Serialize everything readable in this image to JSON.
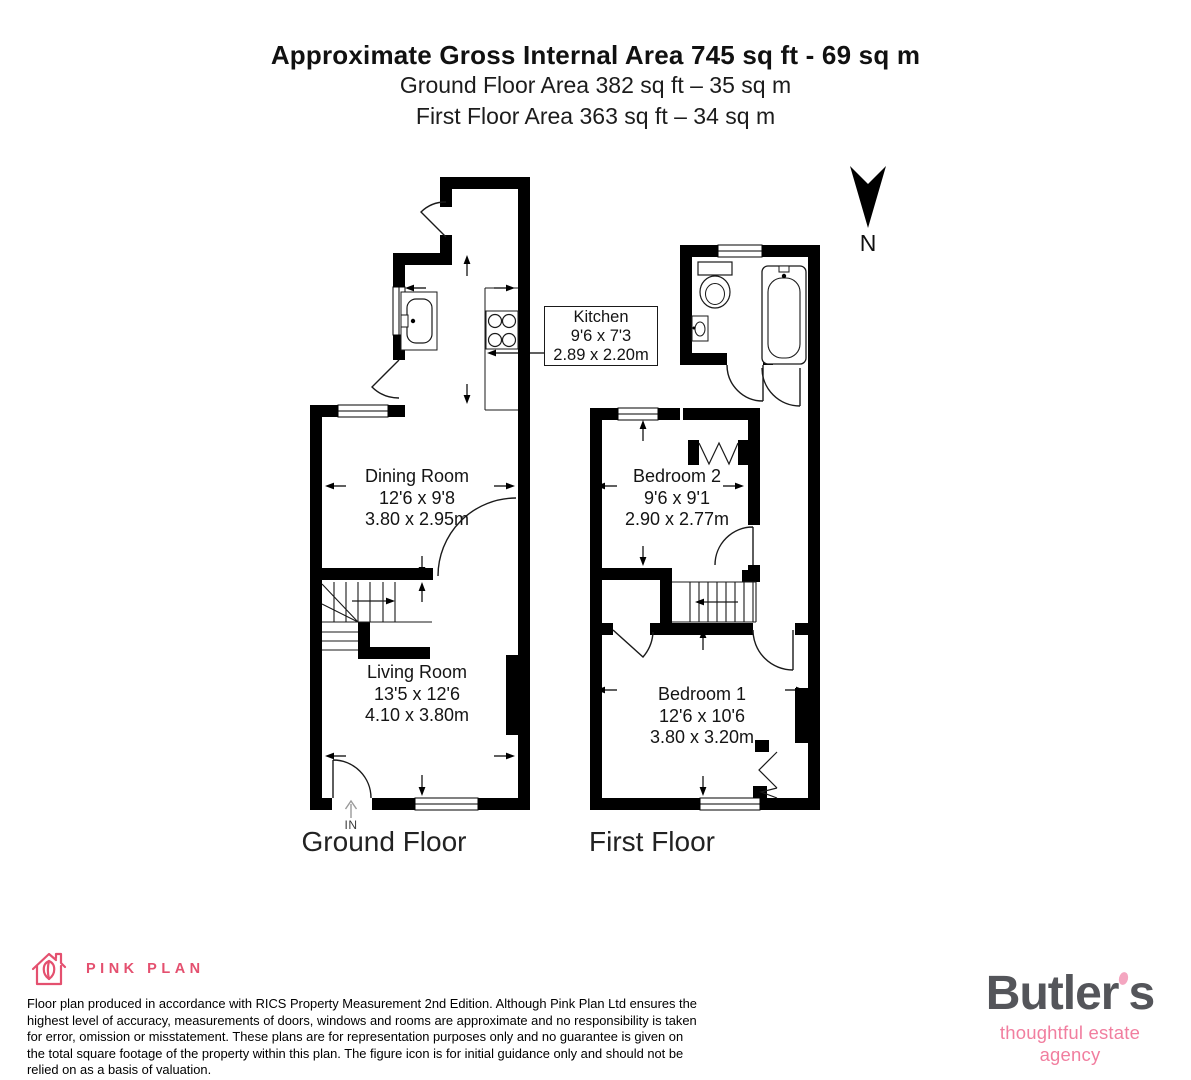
{
  "header": {
    "title": "Approximate Gross Internal Area 745 sq ft - 69 sq m",
    "subtitle_ground": "Ground Floor Area 382 sq ft – 35 sq m",
    "subtitle_first": "First Floor Area 363 sq ft – 34 sq m"
  },
  "north_indicator": {
    "label": "N"
  },
  "floors": {
    "ground": {
      "label": "Ground Floor",
      "entrance_label": "IN",
      "rooms": {
        "kitchen": {
          "name": "Kitchen",
          "imperial": "9'6 x 7'3",
          "metric": "2.89 x 2.20m"
        },
        "dining_room": {
          "name": "Dining Room",
          "imperial": "12'6 x 9'8",
          "metric": "3.80 x 2.95m"
        },
        "living_room": {
          "name": "Living Room",
          "imperial": "13'5 x 12'6",
          "metric": "4.10 x 3.80m"
        }
      }
    },
    "first": {
      "label": "First Floor",
      "rooms": {
        "bedroom_2": {
          "name": "Bedroom 2",
          "imperial": "9'6 x 9'1",
          "metric": "2.90 x 2.77m"
        },
        "bedroom_1": {
          "name": "Bedroom 1",
          "imperial": "12'6 x 10'6",
          "metric": "3.80 x 3.20m"
        }
      }
    }
  },
  "footer": {
    "producer_name": "PINK PLAN",
    "disclaimer": "Floor plan produced in accordance with RICS Property Measurement 2nd Edition. Although Pink Plan Ltd ensures the highest level of accuracy, measurements of doors, windows and rooms are approximate and no responsibility is taken for error, omission or misstatement. These plans are for representation purposes only and no guarantee is given on the total square footage of the property within this plan. The figure icon is for initial guidance only and should not be relied on as a basis of valuation.",
    "brand": {
      "name_pre": "Butler",
      "name_post": "s",
      "tagline": "thoughtful estate agency"
    }
  },
  "colors": {
    "plan_ink": "#000000",
    "pink_plan_pink": "#e4506f",
    "butlers_gray": "#54555a",
    "butlers_pink": "#f17e9f",
    "butlers_dot_pink": "#f4a6c0"
  }
}
